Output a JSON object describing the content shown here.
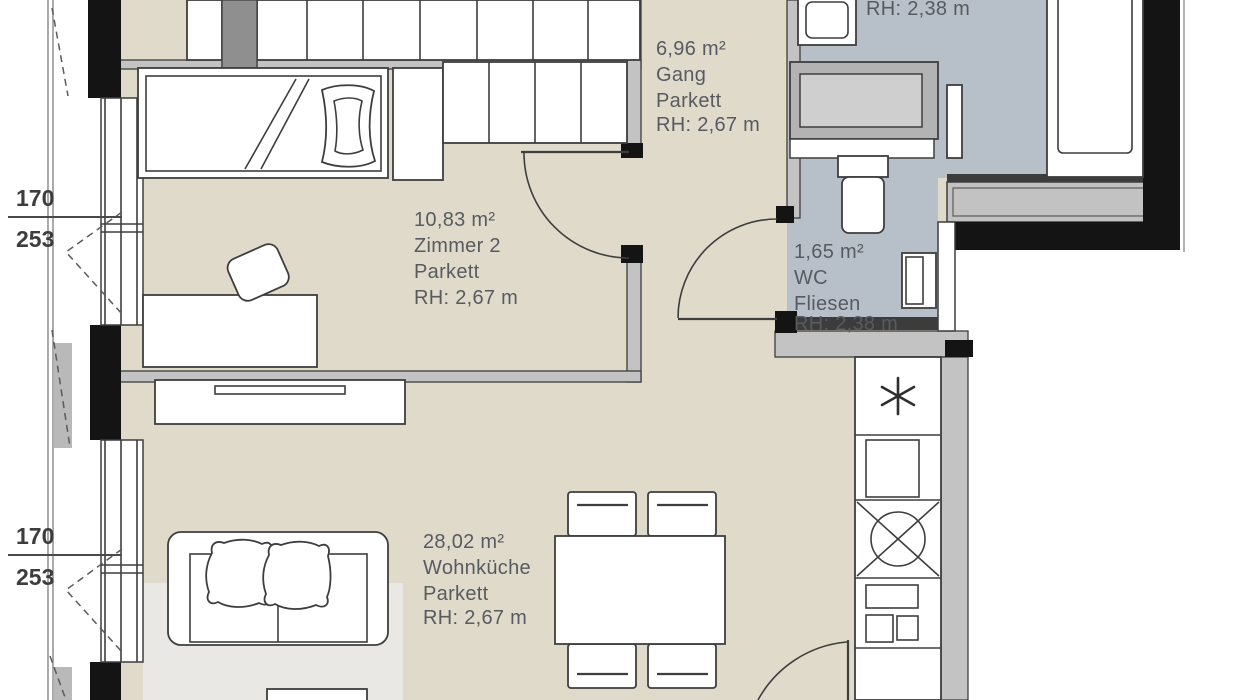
{
  "rooms": {
    "gang": {
      "area": "6,96 m²",
      "name": "Gang",
      "floor": "Parkett",
      "height": "RH: 2,67 m"
    },
    "zimmer2": {
      "area": "10,83 m²",
      "name": "Zimmer 2",
      "floor": "Parkett",
      "height": "RH: 2,67 m"
    },
    "wc": {
      "area": "1,65 m²",
      "name": "WC",
      "floor": "Fliesen",
      "height": "RH: 2,38 m"
    },
    "wohnkueche": {
      "area": "28,02 m²",
      "name": "Wohnküche",
      "floor": "Parkett",
      "height": "RH: 2,67 m"
    },
    "bad": {
      "height": "RH: 2,38 m"
    }
  },
  "dimensions": {
    "window1_width": "170",
    "window1_sill": "253",
    "window2_width": "170",
    "window2_sill": "253"
  },
  "icons": {
    "kitchen_symbol": "asterisk-6-spoke",
    "kitchen_sink": "circle-cross"
  },
  "colors": {
    "parquet_floor": "#e0dacb",
    "tile_floor": "#b7c0c8",
    "wall_gray": "#c3c3c3",
    "wall_black": "#141414",
    "rug": "#e9e8e4",
    "label_text": "#575b61"
  }
}
